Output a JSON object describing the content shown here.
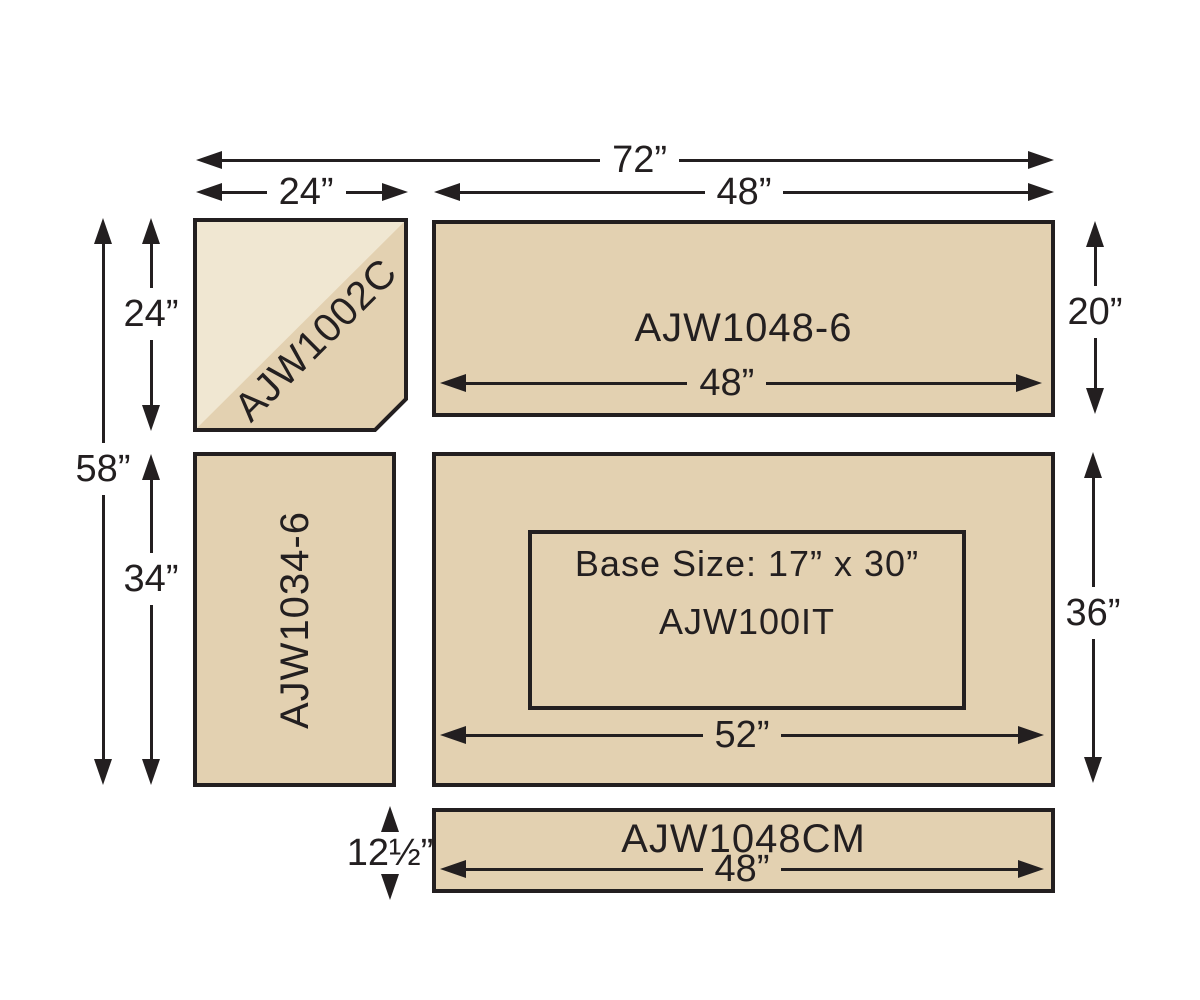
{
  "colors": {
    "tan": "#e3d1b1",
    "light": "#f0e7d2",
    "ink": "#231f20",
    "background": "#ffffff"
  },
  "panels": {
    "corner": {
      "label": "AJW1002C"
    },
    "top": {
      "label": "AJW1048-6"
    },
    "left": {
      "label": "AJW1034-6"
    },
    "island": {
      "label": "AJW100IT",
      "base_size_label": "Base Size: 17” x 30”"
    },
    "strip": {
      "label": "AJW1048CM"
    }
  },
  "dimensions": {
    "total_width": "72”",
    "corner_width": "24”",
    "top_width": "48”",
    "top_inner_width": "48”",
    "top_height": "20”",
    "total_height": "58”",
    "corner_height": "24”",
    "left_height": "34”",
    "island_width": "52”",
    "island_height": "36”",
    "strip_width": "48”",
    "strip_height": "12½”"
  }
}
